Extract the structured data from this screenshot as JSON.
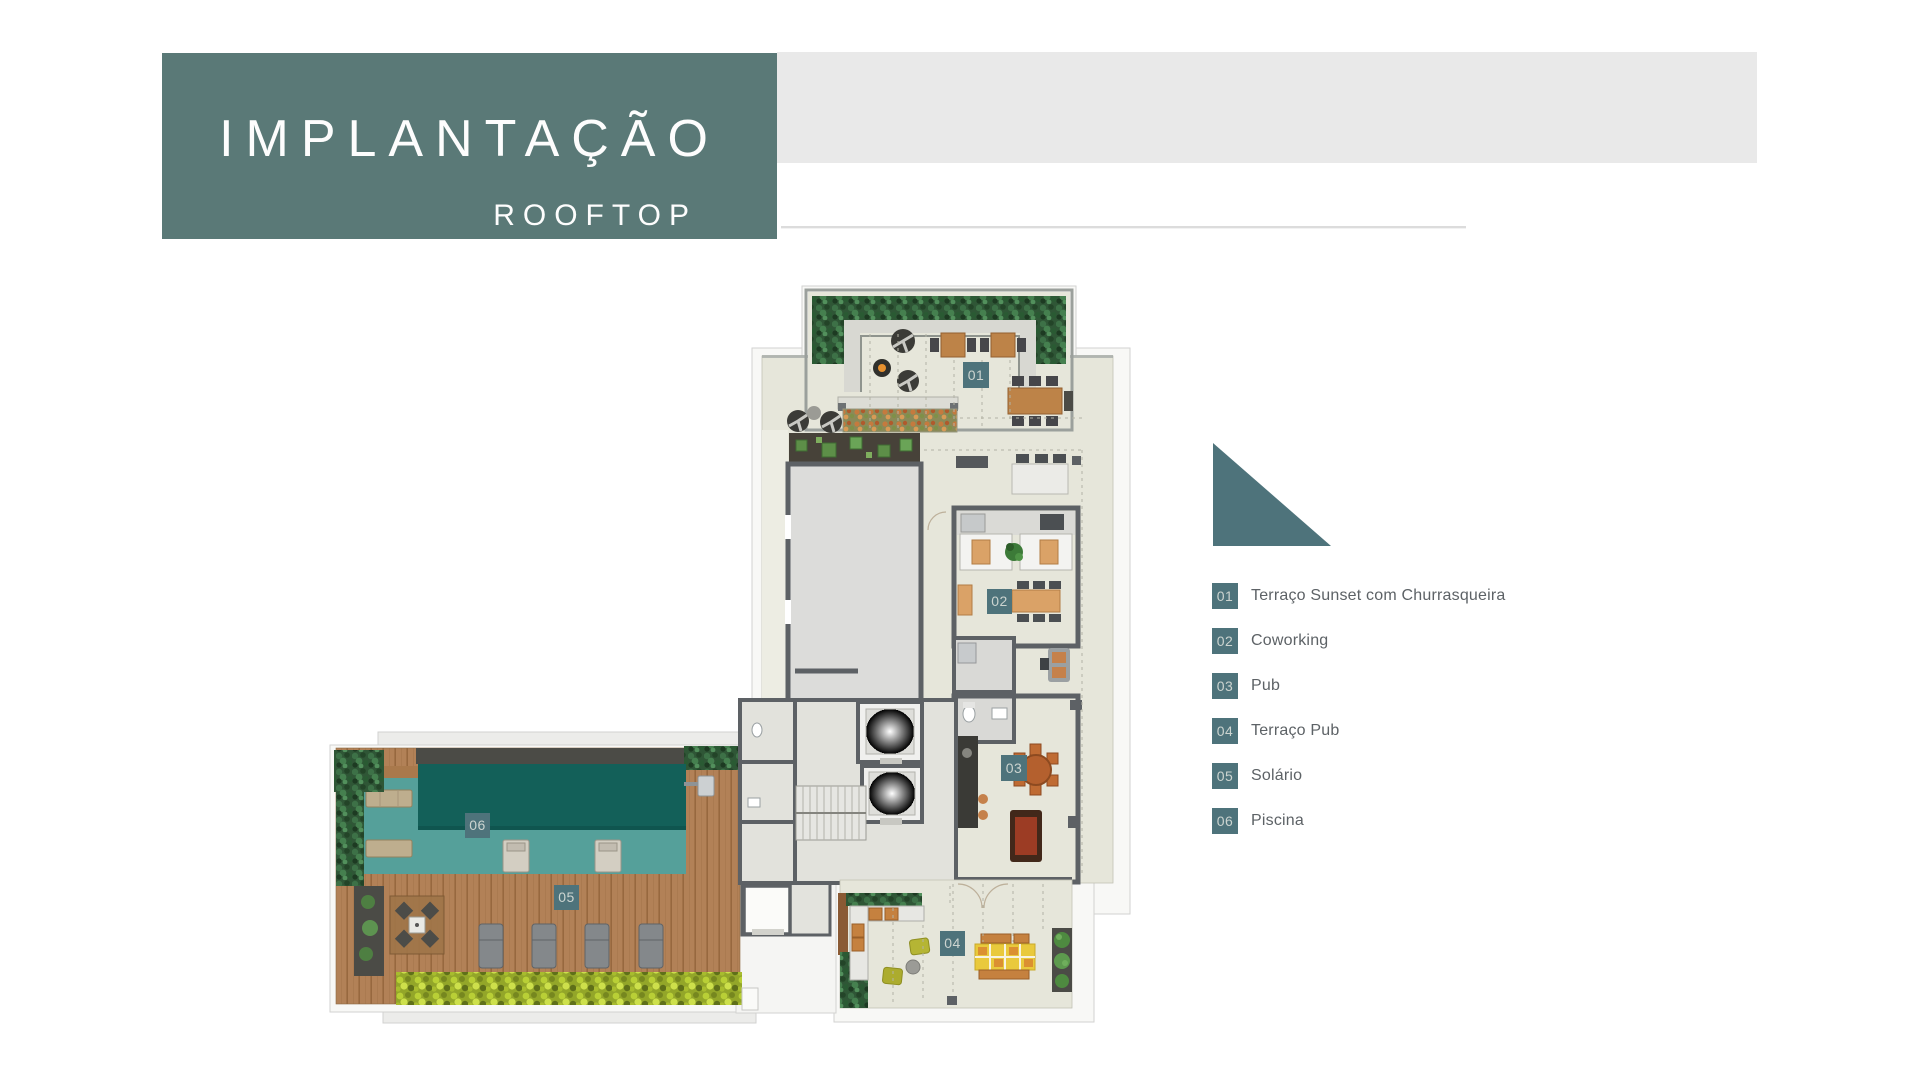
{
  "header": {
    "title": "IMPLANTAÇÃO",
    "subtitle": "ROOFTOP"
  },
  "legend": {
    "items": [
      {
        "num": "01",
        "label": "Terraço Sunset com Churrasqueira"
      },
      {
        "num": "02",
        "label": "Coworking"
      },
      {
        "num": "03",
        "label": "Pub"
      },
      {
        "num": "04",
        "label": "Terraço Pub"
      },
      {
        "num": "05",
        "label": "Solário"
      },
      {
        "num": "06",
        "label": "Piscina"
      }
    ]
  },
  "plan": {
    "badges": [
      "01",
      "02",
      "03",
      "04",
      "05",
      "06"
    ]
  },
  "colors": {
    "accent_teal": "#5a7977",
    "badge_teal": "#4e737b",
    "header_bar_gray": "#e9e9e9",
    "plan_floor": "#e6e6da",
    "pool_deep": "#136059",
    "pool_shallow": "#55a09a",
    "deck_wood": "#b28157",
    "hedge_green": "#2f5636",
    "hedge_yellow": "#93a629"
  }
}
